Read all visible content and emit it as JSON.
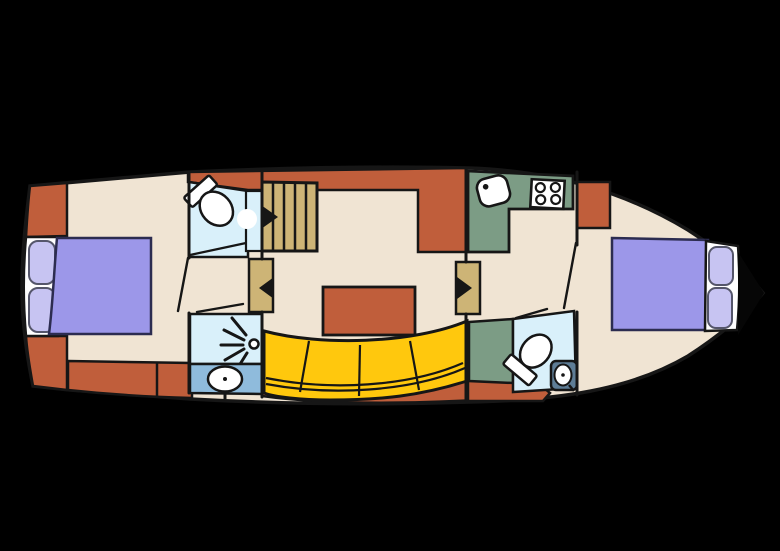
{
  "title": "motor-yacht-deck-plan",
  "palette": {
    "bg": "#000000",
    "hull": "#F0E4D3",
    "trim": "#C05E3B",
    "bed": "#9C97E9",
    "pillow": "#C7C4F2",
    "wet": "#D9F0FA",
    "blue": "#8FBBDC",
    "sofa": "#FFC80D",
    "green": "#7C9C85",
    "wood": "#CDB476",
    "sinkbox": "#5E7D96",
    "white": "#FFFFFF",
    "line": "#161616"
  },
  "features": [
    {
      "name": "aft-cabin",
      "fixtures": [
        "double-bed",
        "pillows"
      ]
    },
    {
      "name": "aft-bathroom",
      "fixtures": [
        "toilet",
        "shower",
        "washbasin"
      ]
    },
    {
      "name": "companionway",
      "fixtures": [
        "stairs",
        "door-arrows"
      ]
    },
    {
      "name": "saloon",
      "fixtures": [
        "dinette-table",
        "curved-sofa"
      ]
    },
    {
      "name": "galley",
      "fixtures": [
        "counter",
        "sink",
        "stove-4-burner"
      ]
    },
    {
      "name": "fore-bathroom",
      "fixtures": [
        "toilet",
        "washbasin"
      ]
    },
    {
      "name": "fore-cabin",
      "fixtures": [
        "double-bed",
        "pillows"
      ]
    },
    {
      "name": "bow-locker",
      "fixtures": []
    }
  ]
}
